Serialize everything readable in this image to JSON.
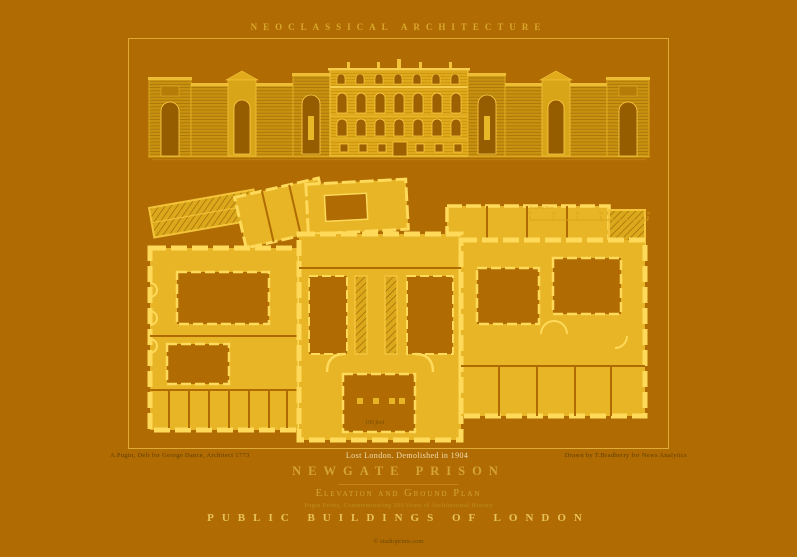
{
  "colors": {
    "background": "#b06c02",
    "gold": "#e7b526",
    "gold_bright": "#ffd95a",
    "gold_pale": "#f0ddb0",
    "title_gold": "#d5a336"
  },
  "header": {
    "title": "NEOCLASSICAL ARCHITECTURE"
  },
  "plate": {
    "plan_scale_note": "100 feet"
  },
  "scale_bar": {
    "caption": "Scale of Feet",
    "ticks": [
      "0",
      "20",
      "40",
      "60",
      "80",
      "100"
    ]
  },
  "captions": {
    "credit_left": "A.Pugin, Delt for George Dance, Architect 1773",
    "demolished": "Lost London. Demolished in 1904",
    "credit_right": "Drawn by T.Bradberry for News Analytics",
    "title": "NEWGATE PRISON",
    "subtitle": "Elevation and Ground Plan",
    "series_note": "Pugin Prints, Commemorating 200 Years of Architectural History",
    "series": "PUBLIC BUILDINGS OF LONDON",
    "copyright": "© studioprints.com"
  }
}
